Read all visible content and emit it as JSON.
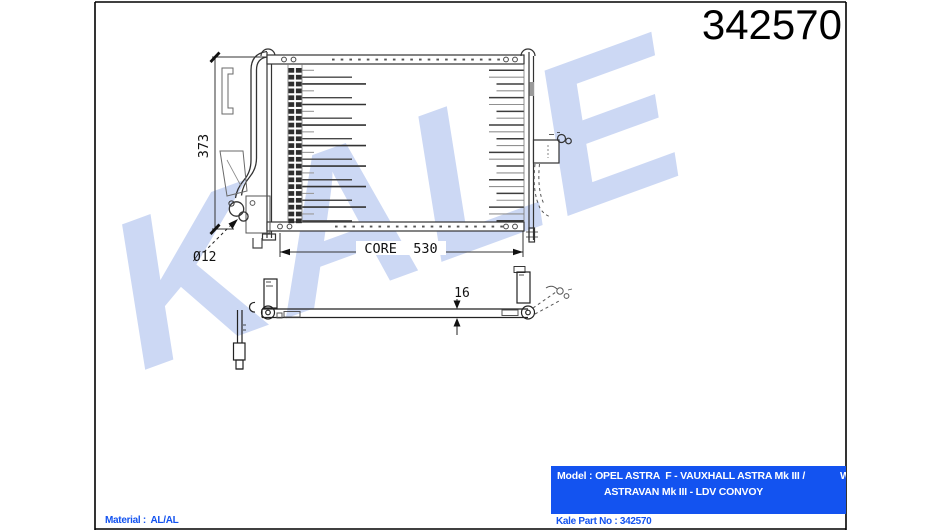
{
  "part_number": "342570",
  "drawing": {
    "watermark": "KALE",
    "dim_height": "373",
    "dim_core": "CORE  530",
    "dim_thickness": "16",
    "dim_port": "Ø12",
    "tick_mark": "1"
  },
  "footer": {
    "model_label": "Model : ",
    "model_line1": "OPEL ASTRA  F - VAUXHALL ASTRA Mk III /",
    "model_line2": "ASTRAVAN Mk III - LDV CONVOY",
    "model_clipped_text": "W",
    "part_no_label": "Kale Part No : ",
    "part_no_value": "342570",
    "material_label": "Material :  ",
    "material_value": "AL/AL"
  },
  "colors": {
    "accent_blue": "#1353f0",
    "watermark_blue": "#ccd8f4"
  }
}
